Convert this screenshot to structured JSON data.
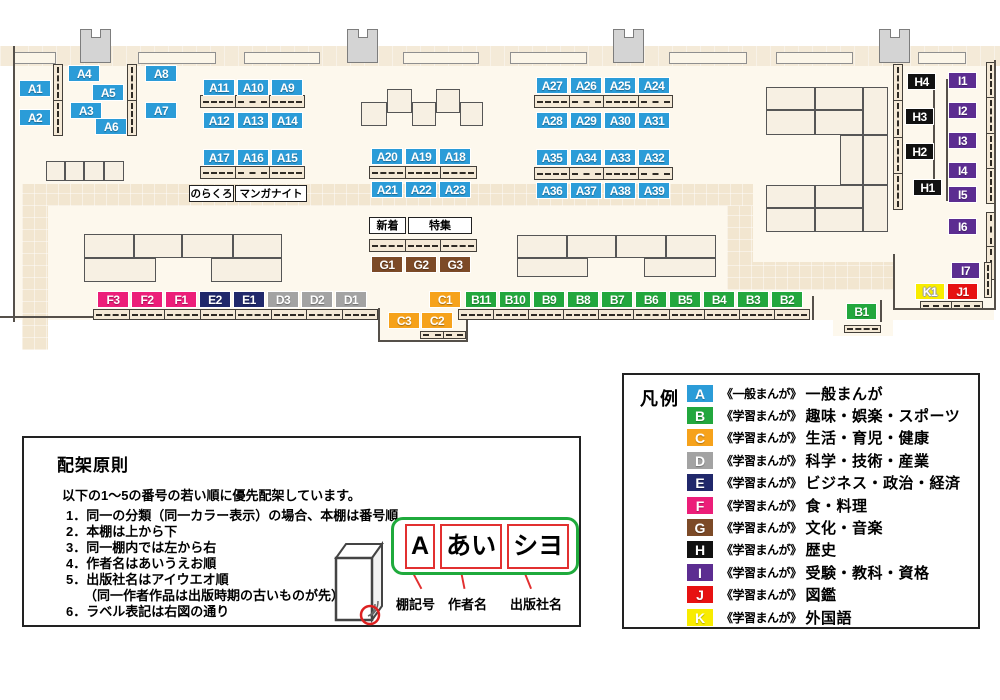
{
  "map": {
    "shelf_labels": [
      "A1",
      "A2",
      "A3",
      "A4",
      "A5",
      "A6",
      "A7",
      "A8",
      "A9",
      "A10",
      "A11",
      "A12",
      "A13",
      "A14",
      "A15",
      "A16",
      "A17",
      "A18",
      "A19",
      "A20",
      "A21",
      "A22",
      "A23",
      "A24",
      "A25",
      "A26",
      "A27",
      "A28",
      "A29",
      "A30",
      "A31",
      "A32",
      "A33",
      "A34",
      "A35",
      "A36",
      "A37",
      "A38",
      "A39",
      "B1",
      "B2",
      "B3",
      "B4",
      "B5",
      "B6",
      "B7",
      "B8",
      "B9",
      "B10",
      "B11",
      "C1",
      "C2",
      "C3",
      "D1",
      "D2",
      "D3",
      "E1",
      "E2",
      "F1",
      "F2",
      "F3",
      "G1",
      "G2",
      "G3",
      "H1",
      "H2",
      "H3",
      "H4",
      "I1",
      "I2",
      "I3",
      "I4",
      "I5",
      "I6",
      "I7",
      "J1",
      "K1"
    ],
    "text_labels": {
      "norakuro": "のらくろ",
      "manga_night": "マンガナイト",
      "new_arrivals": "新着",
      "featured": "特集"
    }
  },
  "category_colors": {
    "A": "#2b9cd8",
    "B": "#22a73d",
    "C": "#f6a21b",
    "D": "#a3a3a3",
    "E": "#20286b",
    "F": "#ec1e79",
    "G": "#7c4a27",
    "H": "#111111",
    "I": "#5c2d91",
    "J": "#e71111",
    "K": "#f8ec00"
  },
  "legend": {
    "title": "凡例",
    "items": [
      {
        "code": "A",
        "prefix": "《一般まんが》",
        "label": "一般まんが"
      },
      {
        "code": "B",
        "prefix": "《学習まんが》",
        "label": "趣味・娯楽・スポーツ"
      },
      {
        "code": "C",
        "prefix": "《学習まんが》",
        "label": "生活・育児・健康"
      },
      {
        "code": "D",
        "prefix": "《学習まんが》",
        "label": "科学・技術・産業"
      },
      {
        "code": "E",
        "prefix": "《学習まんが》",
        "label": "ビジネス・政治・経済"
      },
      {
        "code": "F",
        "prefix": "《学習まんが》",
        "label": "食・料理"
      },
      {
        "code": "G",
        "prefix": "《学習まんが》",
        "label": "文化・音楽"
      },
      {
        "code": "H",
        "prefix": "《学習まんが》",
        "label": "歴史"
      },
      {
        "code": "I",
        "prefix": "《学習まんが》",
        "label": "受験・教科・資格"
      },
      {
        "code": "J",
        "prefix": "《学習まんが》",
        "label": "図鑑"
      },
      {
        "code": "K",
        "prefix": "《学習まんが》",
        "label": "外国語"
      }
    ]
  },
  "principles": {
    "title": "配架原則",
    "intro": "以下の1～5の番号の若い順に優先配架しています。",
    "items": [
      "1．同一の分類（同一カラー表示）の場合、本棚は番号順",
      "2．本棚は上から下",
      "3．同一棚内では左から右",
      "4．作者名はあいうえお順",
      "5．出版社名はアイウエオ順",
      "6．ラベル表記は右図の通り"
    ],
    "item5_note": "（同一作者作品は出版時期の古いものが先）",
    "label_example": {
      "parts": [
        "A",
        "あい",
        "シヨ"
      ],
      "captions": [
        "棚記号",
        "作者名",
        "出版社名"
      ]
    }
  }
}
